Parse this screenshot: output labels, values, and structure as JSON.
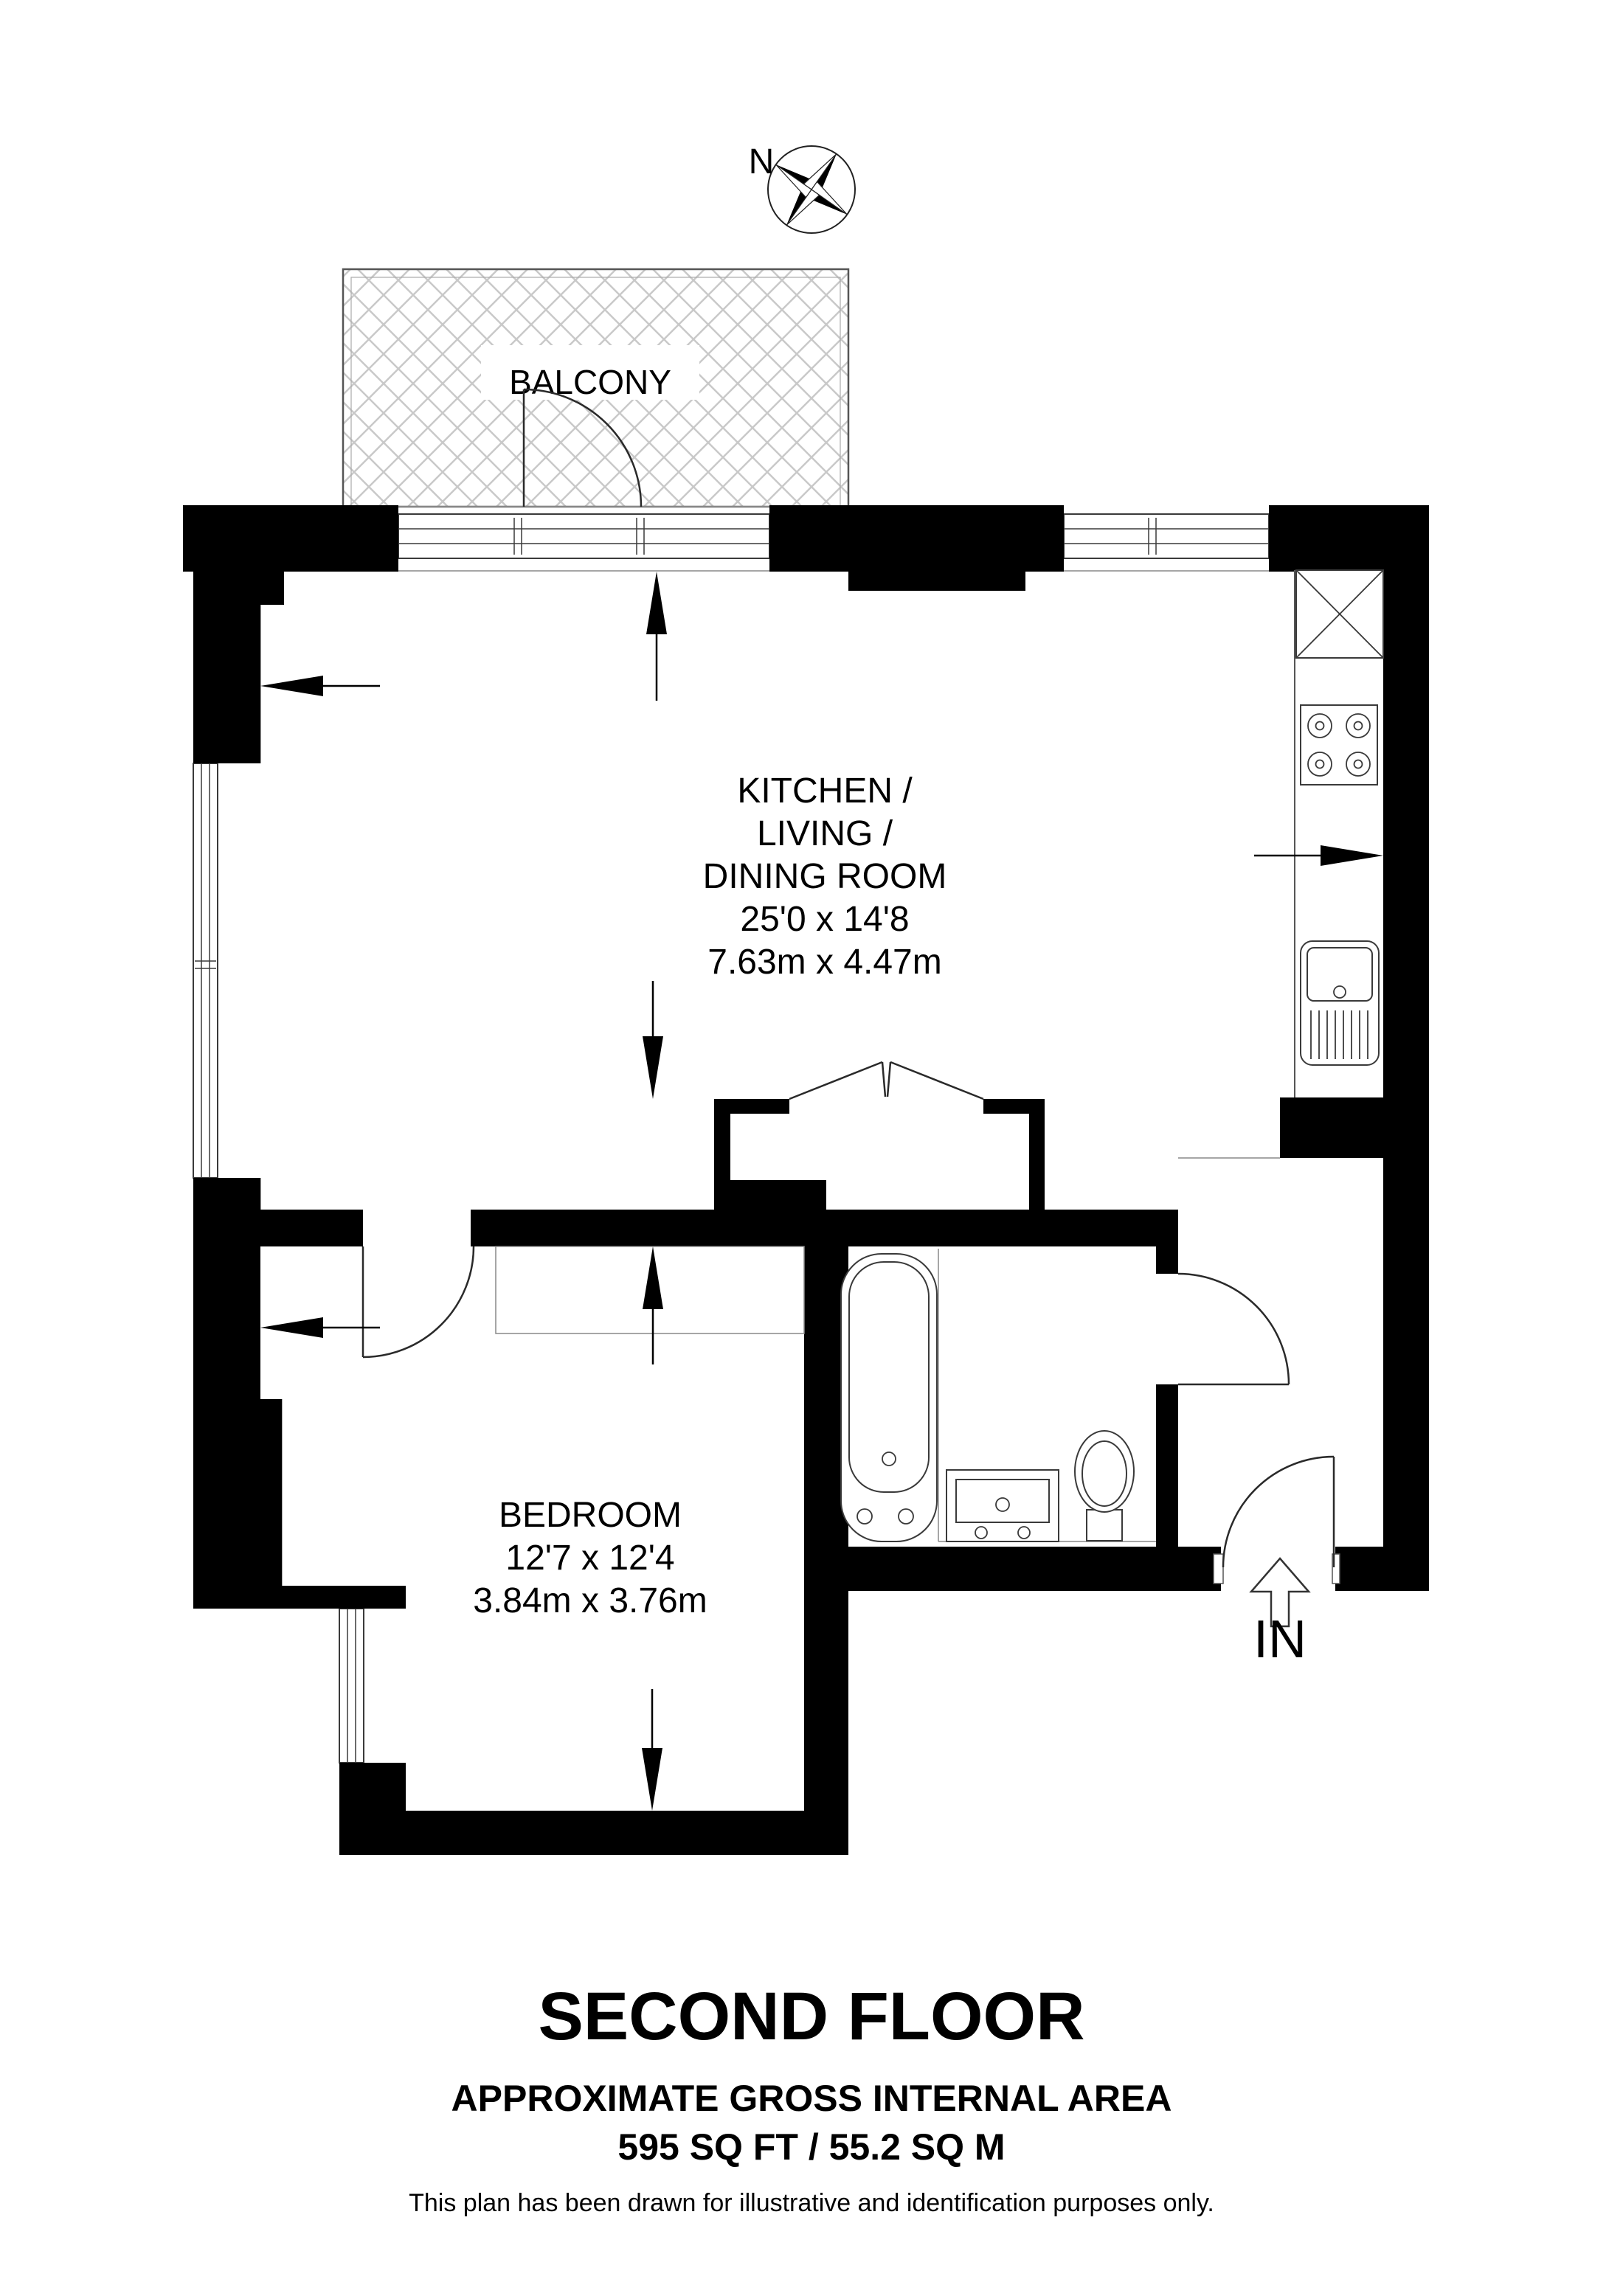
{
  "compass": {
    "north_label": "N"
  },
  "balcony": {
    "label": "BALCONY"
  },
  "kitchen": {
    "lines": [
      "KITCHEN /",
      "LIVING /",
      "DINING ROOM"
    ],
    "size_imperial": "25'0 x 14'8",
    "size_metric": "7.63m x 4.47m"
  },
  "bedroom": {
    "label": "BEDROOM",
    "size_imperial": "12'7 x 12'4",
    "size_metric": "3.84m x 3.76m"
  },
  "entrance": {
    "label": "IN"
  },
  "footer": {
    "title": "SECOND FLOOR",
    "area_heading": "APPROXIMATE GROSS INTERNAL AREA",
    "area_value": "595 SQ FT / 55.2 SQ M",
    "disclaimer": "This plan has been drawn for illustrative and identification purposes only."
  },
  "colors": {
    "wall": "#000000",
    "hatch": "#c9c9c9",
    "outline": "#444444",
    "background": "#ffffff"
  }
}
